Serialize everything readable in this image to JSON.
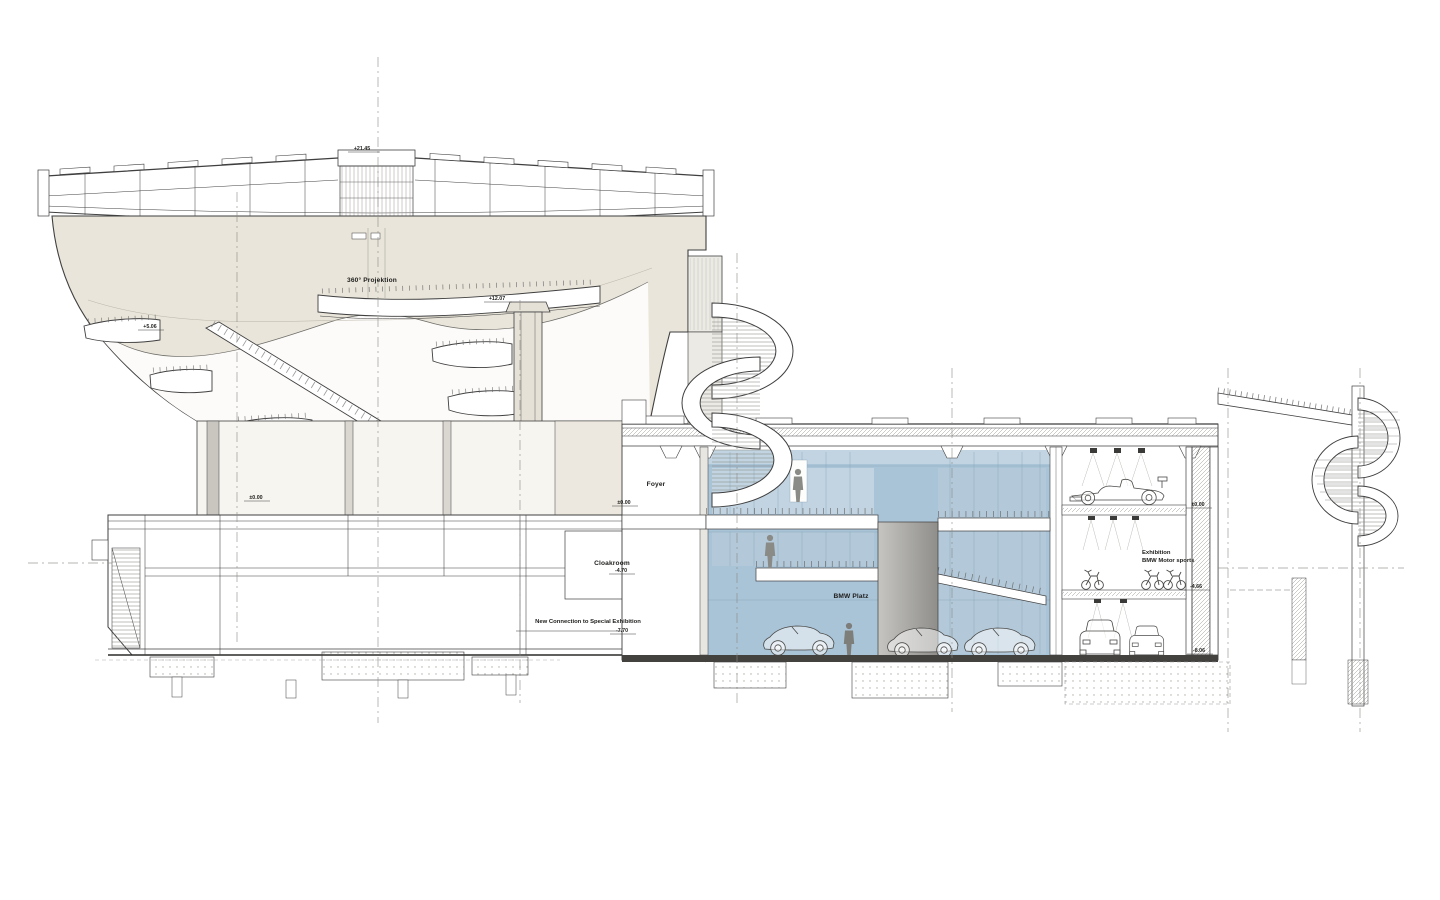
{
  "labels": {
    "projektion": "360° Projektion",
    "foyer": "Foyer",
    "cloakroom": "Cloakroom",
    "bmw_platz": "BMW Platz",
    "new_connection": "New Connection to Special Exhibition",
    "exhibition_1": "Exhibition",
    "exhibition_2": "BMW Motor sports"
  },
  "levels": {
    "bowl_top": "+21.45",
    "bowl_ring": "+12.07",
    "bowl_ramp": "+5.06",
    "entry_left": "±0.00",
    "entry_foyer": "±0.00",
    "cloakroom_lvl": "-4.70",
    "connection_lvl": "-7.70",
    "wing_top": "±0.00",
    "wing_mid": "-4.66",
    "wing_ground": "-8.06"
  },
  "colors": {
    "bowl": "#e9e5da",
    "bowl_panel": "#ece8df",
    "hall_blue": "#a9c3d7",
    "hall_blue_light": "#c2d4e1",
    "hall_blue_mid": "#b3c9d9",
    "ground_dark": "#44423f",
    "line": "#3f3f3f"
  }
}
